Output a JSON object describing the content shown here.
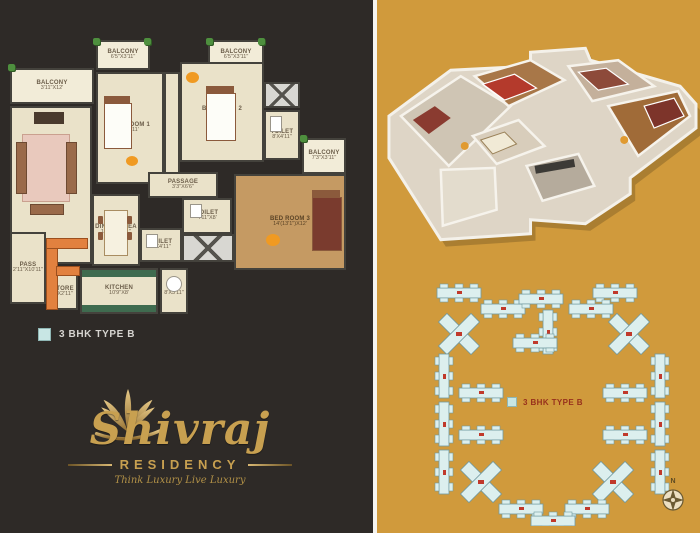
{
  "left_panel": {
    "legend": {
      "label": "3 BHK TYPE B"
    },
    "floorplan": {
      "rooms": [
        {
          "name": "BALCONY",
          "dims": "3'11\"X12'"
        },
        {
          "name": "BALCONY",
          "dims": "6'5\"X3'11\""
        },
        {
          "name": "BED ROOM 1",
          "dims": "13'X11'"
        },
        {
          "name": "BALCONY",
          "dims": "6'5\"X3'11\""
        },
        {
          "name": "BED ROOM 2",
          "dims": "13'X11'"
        },
        {
          "name": "TOILET",
          "dims": "8'X4'11\""
        },
        {
          "name": "BALCONY",
          "dims": "7'3\"X3'11\""
        },
        {
          "name": "LIVING AREA",
          "dims": "12'X21'4\""
        },
        {
          "name": "PASSAGE",
          "dims": "3'3\"X6'6\""
        },
        {
          "name": "BED ROOM 3",
          "dims": "14'(13'1\")X12'"
        },
        {
          "name": "TOILET",
          "dims": "4'11\"X8'"
        },
        {
          "name": "DINING AREA",
          "dims": "11'10\"X8'11\""
        },
        {
          "name": "TOILET",
          "dims": "8'X4'11\""
        },
        {
          "name": "PASS",
          "dims": "2'11\"X10'11\""
        },
        {
          "name": "STORE",
          "dims": "3'X2'11\""
        },
        {
          "name": "KITCHEN",
          "dims": "10'9\"X8'"
        },
        {
          "name": "BAL",
          "dims": "8'X3'11\""
        }
      ]
    },
    "logo": {
      "name": "Shivraj",
      "sub": "RESIDENCY",
      "tagline": "Think Luxury Live Luxury"
    }
  },
  "right_panel": {
    "legend": {
      "label": "3 BHK TYPE B"
    },
    "compass": {
      "label": "N"
    }
  },
  "colors": {
    "left_bg": "#2e2a27",
    "right_bg": "#d09a3c",
    "brand_gold": "#c8a050",
    "legend_swatch": "#c8e6e4",
    "site_building": "#dcefee",
    "site_number_red": "#c0392b"
  }
}
